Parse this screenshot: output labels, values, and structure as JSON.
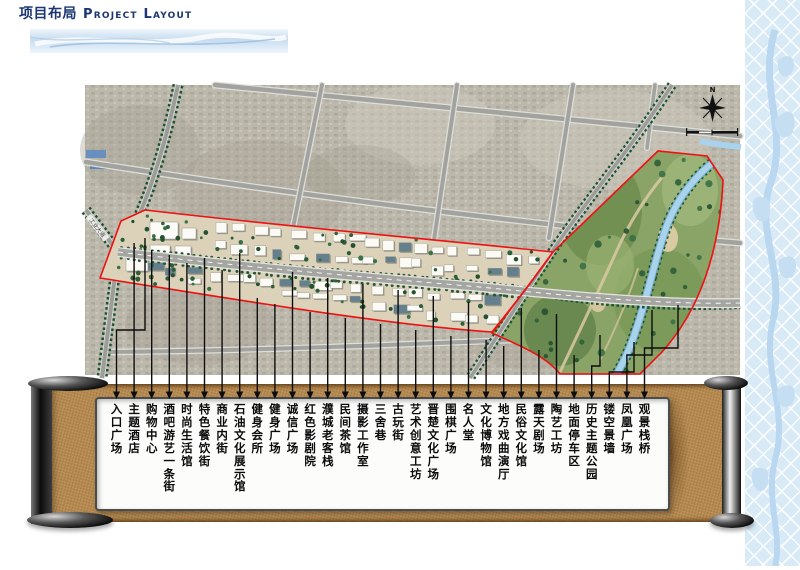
{
  "header": {
    "title_cn": "项目布局",
    "title_en": "Project Layout"
  },
  "map": {
    "compass": "N",
    "road_label": "工业大道"
  },
  "legend": {
    "labels": [
      "入口广场",
      "主题酒店",
      "购物中心",
      "酒吧游艺一条街",
      "时尚生活馆",
      "特色餐饮街",
      "商业内街",
      "石油文化展示馆",
      "健身会所",
      "健身广场",
      "诚信广场",
      "红色影剧院",
      "濮城老客栈",
      "民间茶馆",
      "摄影工作室",
      "三舍巷",
      "古玩街",
      "艺术创意工坊",
      "晋楚文化广场",
      "围棋广场",
      "名人堂",
      "文化博物馆",
      "地方戏曲演厅",
      "民俗文化馆",
      "露天剧场",
      "陶艺工坊",
      "地面停车区",
      "历史主题公园",
      "镂空景墙",
      "凤凰广场",
      "观景栈桥"
    ]
  },
  "colors": {
    "boundary_red": "#ee1111",
    "scroll_tan": "#b5894f",
    "banner_blue": "#c7dcef",
    "title_navy": "#1c3674",
    "river_blue": "#a9d2ec"
  }
}
